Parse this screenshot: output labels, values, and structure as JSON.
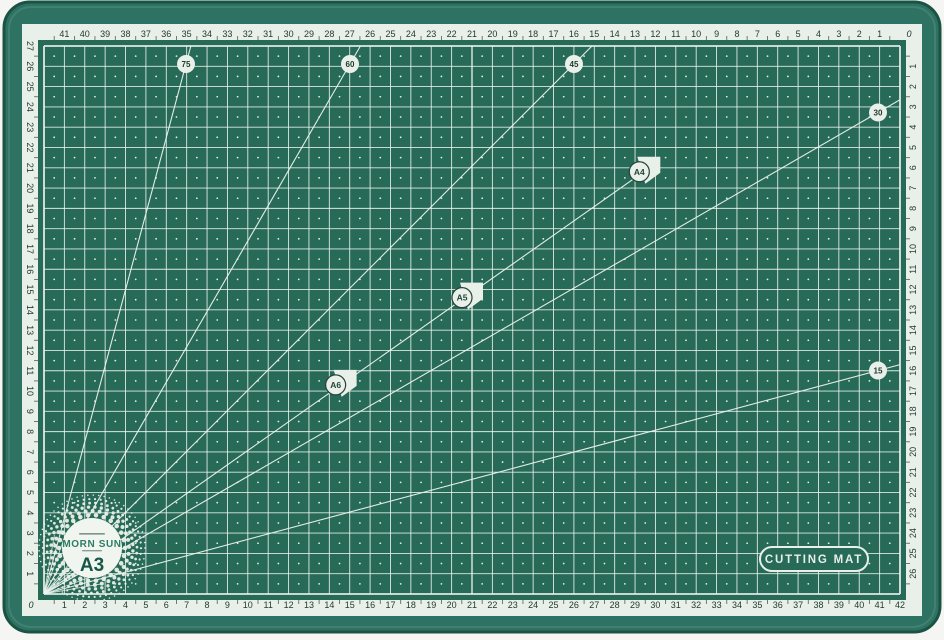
{
  "colors": {
    "page_bg": "#f5f6f4",
    "mat_edge": "#2d7262",
    "mat_surface": "#266a57",
    "mat_shadow": "#1a5244",
    "ruler_band": "#e9efe9",
    "ink": "#223b30",
    "line_white": "#eef4ee",
    "logo_green": "#2c7c66",
    "logo_dark_green": "#175748"
  },
  "badge": {
    "label": "CUTTING MAT"
  },
  "logo": {
    "brand": "MORN SUN",
    "size_label": "A3"
  },
  "grid": {
    "cols": 42,
    "rows": 27
  },
  "rulers": {
    "zero_label": "0",
    "top": [
      41,
      40,
      39,
      38,
      37,
      36,
      35,
      34,
      33,
      32,
      31,
      30,
      29,
      28,
      27,
      26,
      25,
      24,
      23,
      22,
      21,
      20,
      19,
      18,
      17,
      16,
      15,
      14,
      13,
      12,
      11,
      10,
      9,
      8,
      7,
      6,
      5,
      4,
      3,
      2,
      1
    ],
    "bottom": [
      1,
      2,
      3,
      4,
      5,
      6,
      7,
      8,
      9,
      10,
      11,
      12,
      13,
      14,
      15,
      16,
      17,
      18,
      19,
      20,
      21,
      22,
      23,
      24,
      25,
      26,
      27,
      28,
      29,
      30,
      31,
      32,
      33,
      34,
      35,
      36,
      37,
      38,
      39,
      40,
      41,
      42
    ],
    "left": [
      27,
      26,
      25,
      24,
      23,
      22,
      21,
      20,
      19,
      18,
      17,
      16,
      15,
      14,
      13,
      12,
      11,
      10,
      9,
      8,
      7,
      6,
      5,
      4,
      3,
      2,
      1
    ],
    "right": [
      1,
      2,
      3,
      4,
      5,
      6,
      7,
      8,
      9,
      10,
      11,
      12,
      13,
      14,
      15,
      16,
      17,
      18,
      19,
      20,
      21,
      22,
      23,
      24,
      25,
      26
    ]
  },
  "angle_lines": [
    75,
    60,
    45,
    30,
    15
  ],
  "protractor_fan_degrees": [
    10,
    20,
    30,
    40,
    50,
    60,
    70,
    80
  ],
  "paper_flags": [
    {
      "label": "A4",
      "width_cm": 29.7,
      "height_cm": 21
    },
    {
      "label": "A5",
      "width_cm": 21,
      "height_cm": 14.8
    },
    {
      "label": "A6",
      "width_cm": 14.8,
      "height_cm": 10.5
    }
  ]
}
